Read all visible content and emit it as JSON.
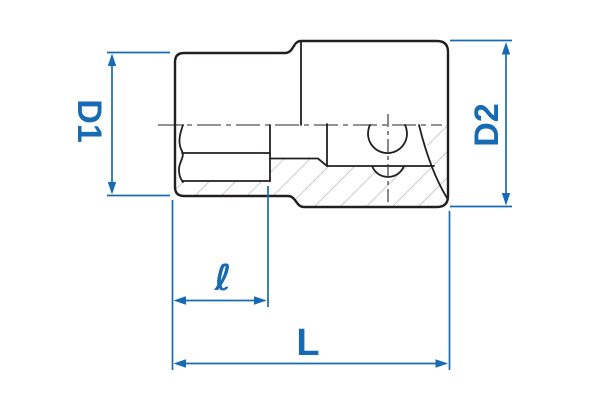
{
  "drawing": {
    "title": "socket cross-section dimension drawing",
    "labels": {
      "d1": "D1",
      "d2": "D2",
      "length_inner": "ℓ",
      "length_total": "L"
    },
    "colors": {
      "dimension_blue": "#176ab4",
      "outline_black": "#231f20",
      "hatch_gray": "#a9abae",
      "centerline_gray": "#6d6e71",
      "background": "#ffffff"
    }
  }
}
